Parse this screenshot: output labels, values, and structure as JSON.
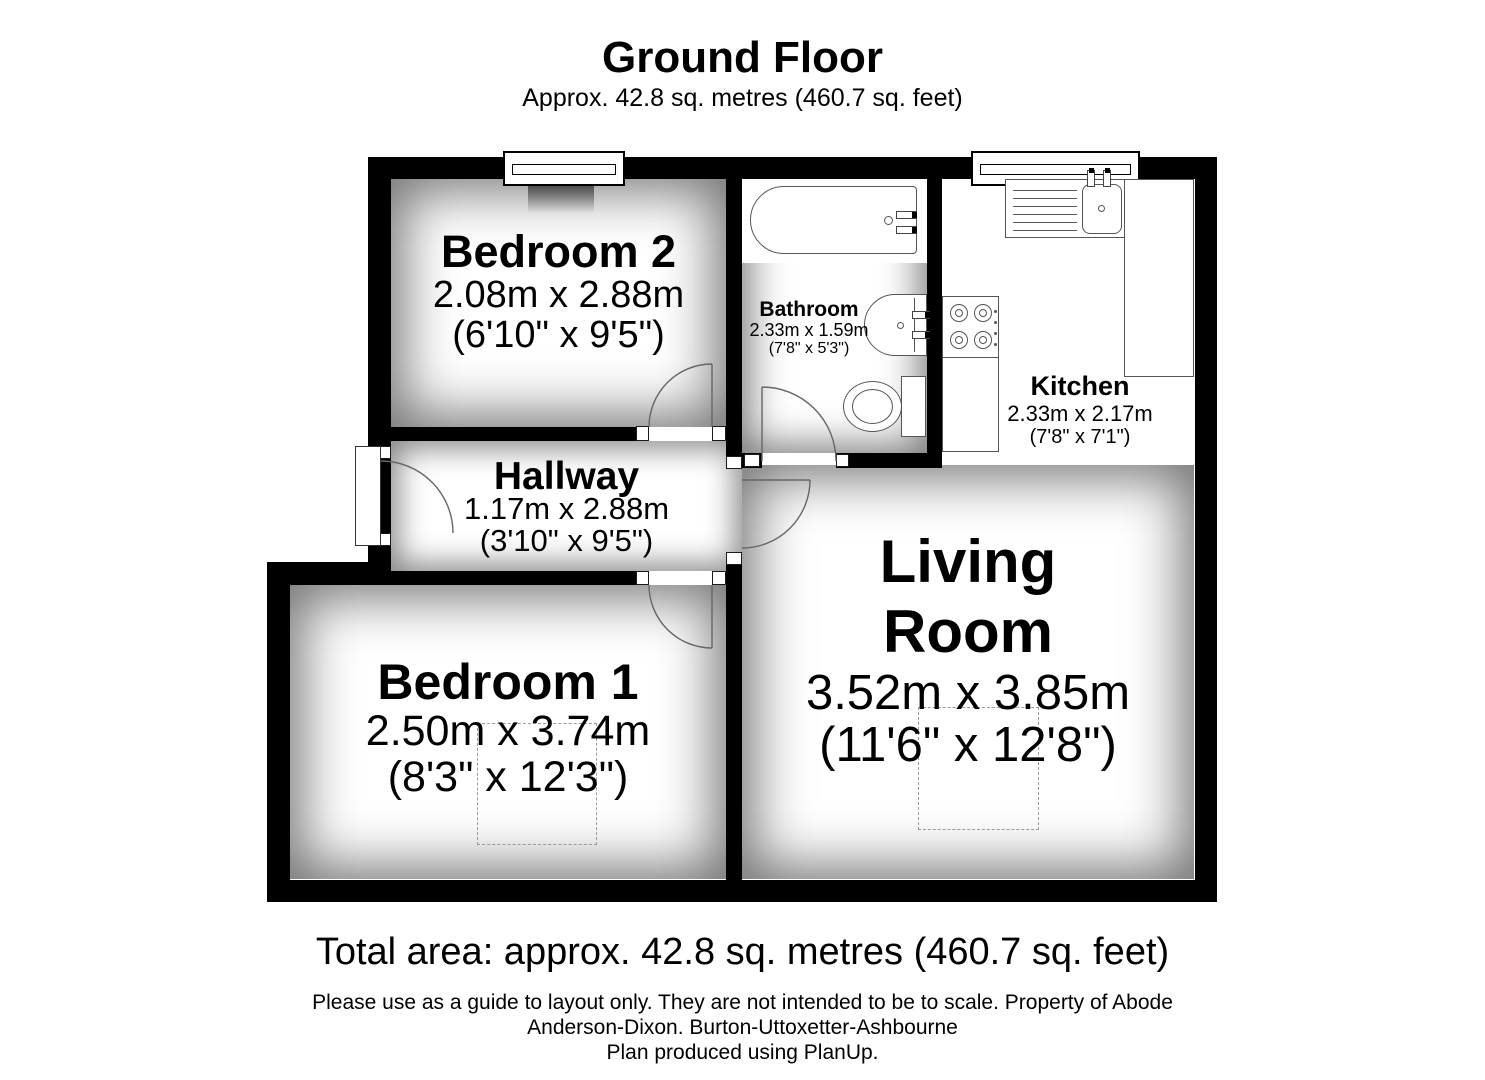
{
  "title": {
    "heading": "Ground Floor",
    "subheading": "Approx. 42.8 sq. metres (460.7 sq. feet)"
  },
  "rooms": {
    "bedroom2": {
      "name": "Bedroom 2",
      "metric": "2.08m x 2.88m",
      "imperial": "(6'10\" x 9'5\")"
    },
    "bathroom": {
      "name": "Bathroom",
      "metric": "2.33m x 1.59m",
      "imperial": "(7'8\" x 5'3\")"
    },
    "kitchen": {
      "name": "Kitchen",
      "metric": "2.33m x 2.17m",
      "imperial": "(7'8\" x 7'1\")"
    },
    "hallway": {
      "name": "Hallway",
      "metric": "1.17m x 2.88m",
      "imperial": "(3'10\" x 9'5\")"
    },
    "bedroom1": {
      "name": "Bedroom 1",
      "metric": "2.50m x 3.74m",
      "imperial": "(8'3\" x 12'3\")"
    },
    "living_room": {
      "name_line1": "Living",
      "name_line2": "Room",
      "metric": "3.52m x 3.85m",
      "imperial": "(11'6\" x 12'8\")"
    }
  },
  "fixtures": {
    "bathroom": [
      "bathtub",
      "sink",
      "toilet"
    ],
    "kitchen": [
      "sink-drainer-counter",
      "hob",
      "worktop"
    ]
  },
  "footer": {
    "total_area": "Total area: approx. 42.8 sq. metres (460.7 sq. feet)",
    "disclaimer1": "Please use as a guide to layout only. They are not intended to be to scale. Property of Abode",
    "disclaimer2": "Anderson-Dixon. Burton-Uttoxetter-Ashbourne",
    "disclaimer3": "Plan produced using PlanUp."
  },
  "colors": {
    "wall": "#000000",
    "floor": "#ffffff",
    "door_line": "#666666",
    "fixture_line": "#555555"
  }
}
